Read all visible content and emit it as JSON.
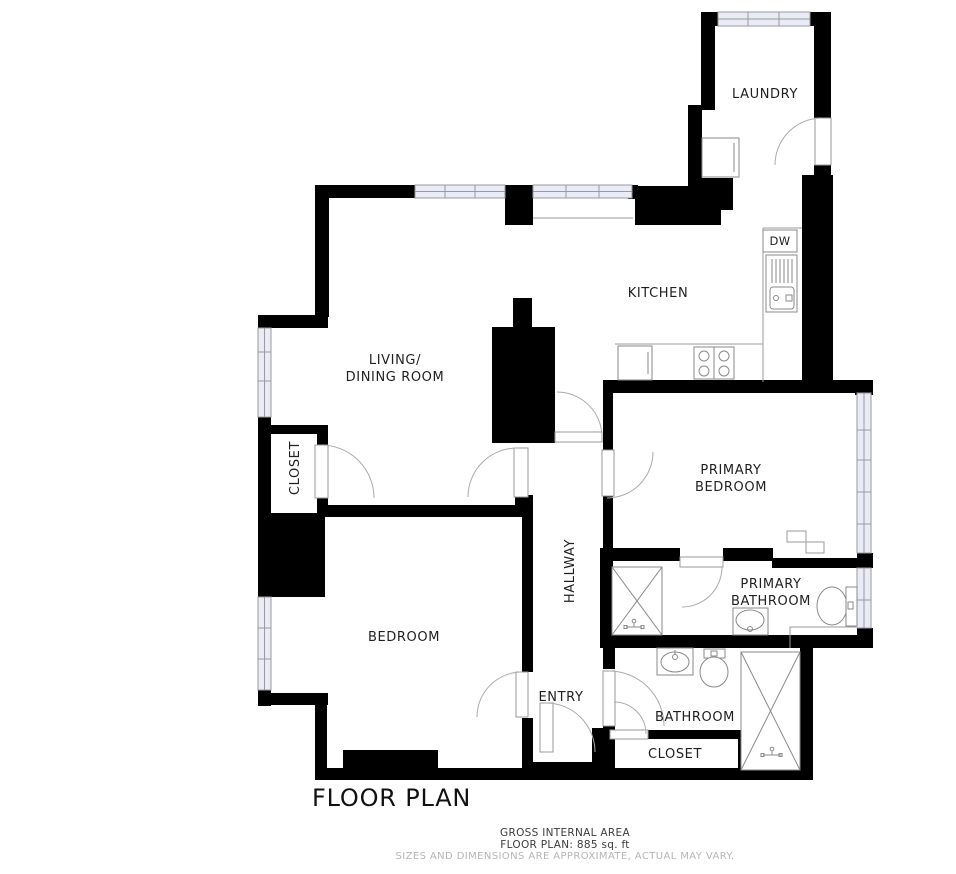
{
  "title": "FLOOR PLAN",
  "footer": {
    "line1": "GROSS INTERNAL AREA",
    "line2": "FLOOR PLAN: 885 sq. ft",
    "line3": "SIZES AND DIMENSIONS ARE APPROXIMATE, ACTUAL MAY VARY."
  },
  "rooms": {
    "laundry": "LAUNDRY",
    "kitchen": "KITCHEN",
    "living_line1": "LIVING/",
    "living_line2": "DINING ROOM",
    "closet_left": "CLOSET",
    "primary_bedroom_line1": "PRIMARY",
    "primary_bedroom_line2": "BEDROOM",
    "primary_bathroom_line1": "PRIMARY",
    "primary_bathroom_line2": "BATHROOM",
    "bedroom": "BEDROOM",
    "hallway": "HALLWAY",
    "entry": "ENTRY",
    "bathroom": "BATHROOM",
    "closet_bathroom": "CLOSET"
  },
  "appliances": {
    "dishwasher": "DW"
  },
  "colors": {
    "wall": "#000000",
    "window_fill": "#e9ecf7",
    "line_gray": "#9a9a9a",
    "fixture_gray": "#8a8a8a",
    "label_text": "#1f1f1f",
    "footer_dark": "#3c3c3c",
    "footer_muted": "#b5b5b5",
    "background": "#ffffff"
  }
}
